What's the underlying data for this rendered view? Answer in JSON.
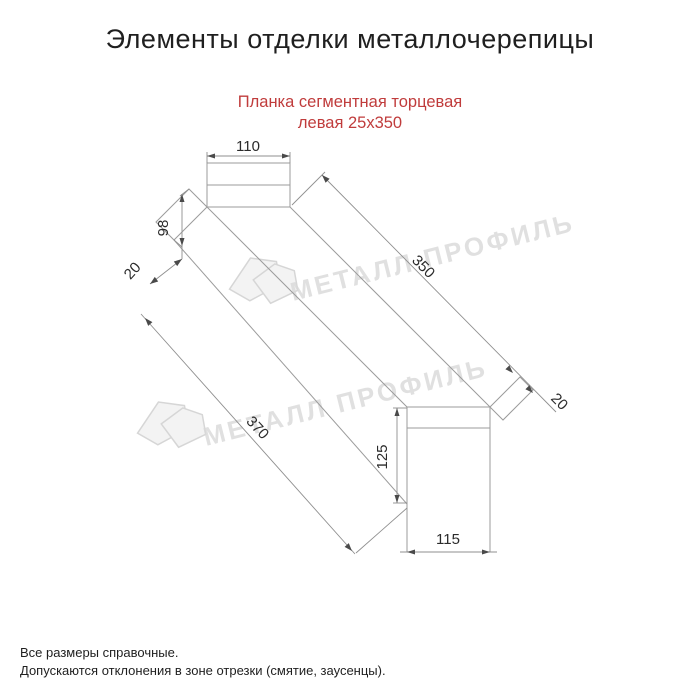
{
  "page": {
    "title": "Элементы отделки металлочерепицы"
  },
  "product": {
    "subtitle_line1": "Планка сегментная торцевая",
    "subtitle_line2": "левая 25x350"
  },
  "drawing": {
    "type": "dimensioned technical drawing, isometric strip profile",
    "dimensions": {
      "top_cap_width": "110",
      "left_end_height": "98",
      "left_hem": "20",
      "strip_length": "350",
      "overall_length": "370",
      "right_hem": "20",
      "end_cap_height": "125",
      "end_cap_width": "115"
    }
  },
  "watermark": {
    "text": "МЕТАЛЛ ПРОФИЛЬ",
    "logo": "metall-profil-house-logo"
  },
  "notes": {
    "line1": "Все размеры справочные.",
    "line2": "Допускаются отклонения в зоне отрезки (смятие, заусенцы)."
  },
  "colors": {
    "background": "#ffffff",
    "title_text": "#1f1f1f",
    "subtitle_red": "#c03c3c",
    "drawing_line_gray": "#9b9b9b",
    "dimension_text": "#2b2b2b",
    "watermark_gray": "#d9d9d9"
  }
}
